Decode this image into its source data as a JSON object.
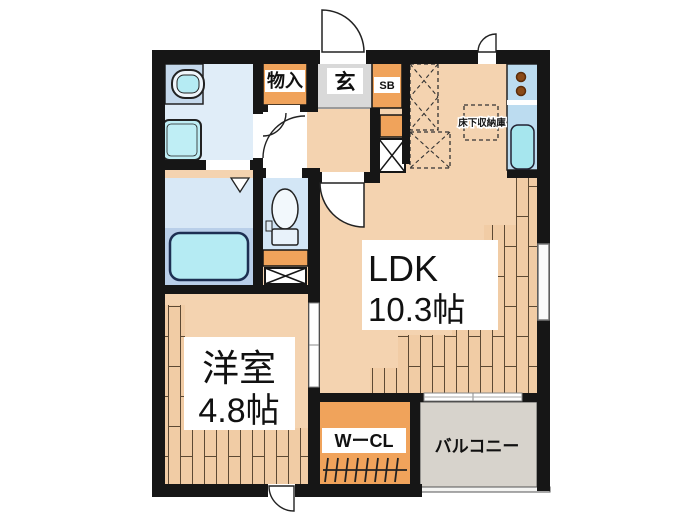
{
  "plan": {
    "type": "apartment-floor-plan",
    "rooms": {
      "ldk": {
        "name": "LDK",
        "area": "10.3帖"
      },
      "western_room": {
        "name": "洋室",
        "area": "4.8帖"
      },
      "walk_in_closet": {
        "name": "WーCL"
      },
      "balcony": {
        "name": "バルコニー"
      },
      "storage": {
        "name": "物入"
      },
      "entrance": {
        "name": "玄"
      },
      "shoe_box": {
        "name": "SB"
      },
      "underfloor_storage": {
        "name": "床下収納庫"
      }
    },
    "colors": {
      "wall": "#161616",
      "floor_main": "#f4d3b0",
      "floor_wood": "#f1cca5",
      "wood_line": "#5d4933",
      "closet_orange": "#f0a35b",
      "entrance_gray": "#d9d9d9",
      "balcony_gray": "#d7d3cc",
      "washroom_blue": "#e0edf8",
      "bath_upper": "#d8e8f6",
      "bath_lower": "#b9cfe9",
      "tub_cyan": "#b5ebf3",
      "toilet_blue": "#d3e6f6",
      "counter_blue": "#bcdcf0",
      "sink_cyan": "#a6e6ee",
      "burner_brown": "#8a4a17",
      "label_bg": "#ffffff"
    }
  }
}
